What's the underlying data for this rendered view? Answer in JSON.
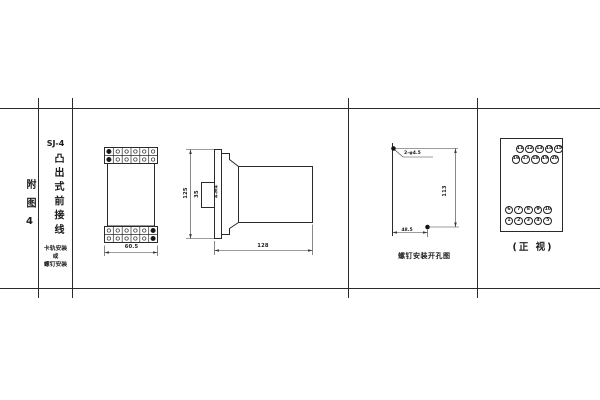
{
  "page": {
    "background": "#ffffff",
    "line_color": "#2a2a2a"
  },
  "index_label": "附图4",
  "title_block": {
    "model": "SJ-4",
    "mount_type": "凸出式前接线",
    "mount_note_line1": "卡轨安装",
    "mount_note_line2": "或",
    "mount_note_line3": "螺钉安装"
  },
  "front_view": {
    "width_dim": "60.5"
  },
  "side_view": {
    "height_dim": "125",
    "bracket_dim": "35",
    "screw_label": "4-M4",
    "depth_dim": "128"
  },
  "drill_view": {
    "caption": "螺钉安装开孔图",
    "holes_label": "2-φ4.5",
    "height_dim": "113",
    "width_dim": "48.5"
  },
  "terminal_view": {
    "caption": "(正 视)",
    "top_rows": [
      [
        "11",
        "12",
        "13",
        "14",
        "15"
      ],
      [
        "16",
        "17",
        "18",
        "19",
        "20"
      ]
    ],
    "bottom_rows": [
      [
        "6",
        "7",
        "8",
        "9",
        "10"
      ],
      [
        "1",
        "2",
        "3",
        "4",
        "5"
      ]
    ]
  }
}
